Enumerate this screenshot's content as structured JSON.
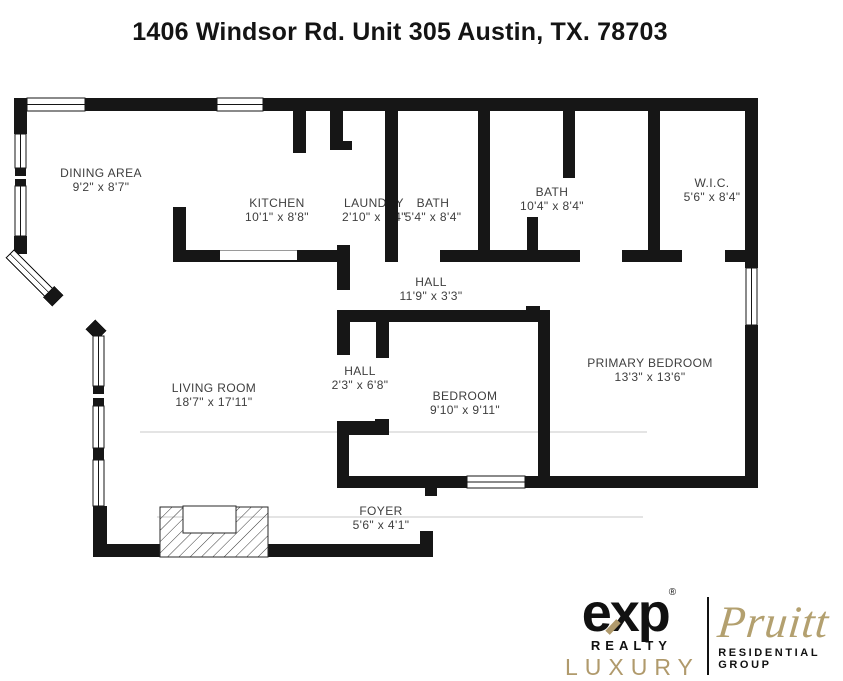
{
  "title": "1406 Windsor Rd. Unit 305 Austin, TX. 78703",
  "rooms": [
    {
      "id": "dining-area",
      "name": "DINING AREA",
      "dims": "9'2\" x 8'7\""
    },
    {
      "id": "kitchen",
      "name": "KITCHEN",
      "dims": "10'1\" x 8'8\""
    },
    {
      "id": "laundry",
      "name": "LAUNDRY",
      "dims": "2'10\" x 8'4\""
    },
    {
      "id": "bath-small",
      "name": "BATH",
      "dims": "5'4\" x 8'4\""
    },
    {
      "id": "bath-large",
      "name": "BATH",
      "dims": "10'4\" x 8'4\""
    },
    {
      "id": "walk-in-closet",
      "name": "W.I.C.",
      "dims": "5'6\" x 8'4\""
    },
    {
      "id": "hall-upper",
      "name": "HALL",
      "dims": "11'9\" x 3'3\""
    },
    {
      "id": "hall-lower",
      "name": "HALL",
      "dims": "2'3\" x 6'8\""
    },
    {
      "id": "living-room",
      "name": "LIVING ROOM",
      "dims": "18'7\" x 17'11\""
    },
    {
      "id": "bedroom",
      "name": "BEDROOM",
      "dims": "9'10\" x 9'11\""
    },
    {
      "id": "primary-bedroom",
      "name": "PRIMARY BEDROOM",
      "dims": "13'3\" x 13'6\""
    },
    {
      "id": "foyer",
      "name": "FOYER",
      "dims": "5'6\" x 4'1\""
    }
  ],
  "branding": {
    "exp_e": "e",
    "exp_x": "x",
    "exp_p": "p",
    "registered_mark": "®",
    "realty": "REALTY",
    "luxury": "LUXURY",
    "script_name": "Pruitt",
    "group": "RESIDENTIAL GROUP",
    "gold_color": "#b09a6c",
    "wall_color": "#161616"
  }
}
